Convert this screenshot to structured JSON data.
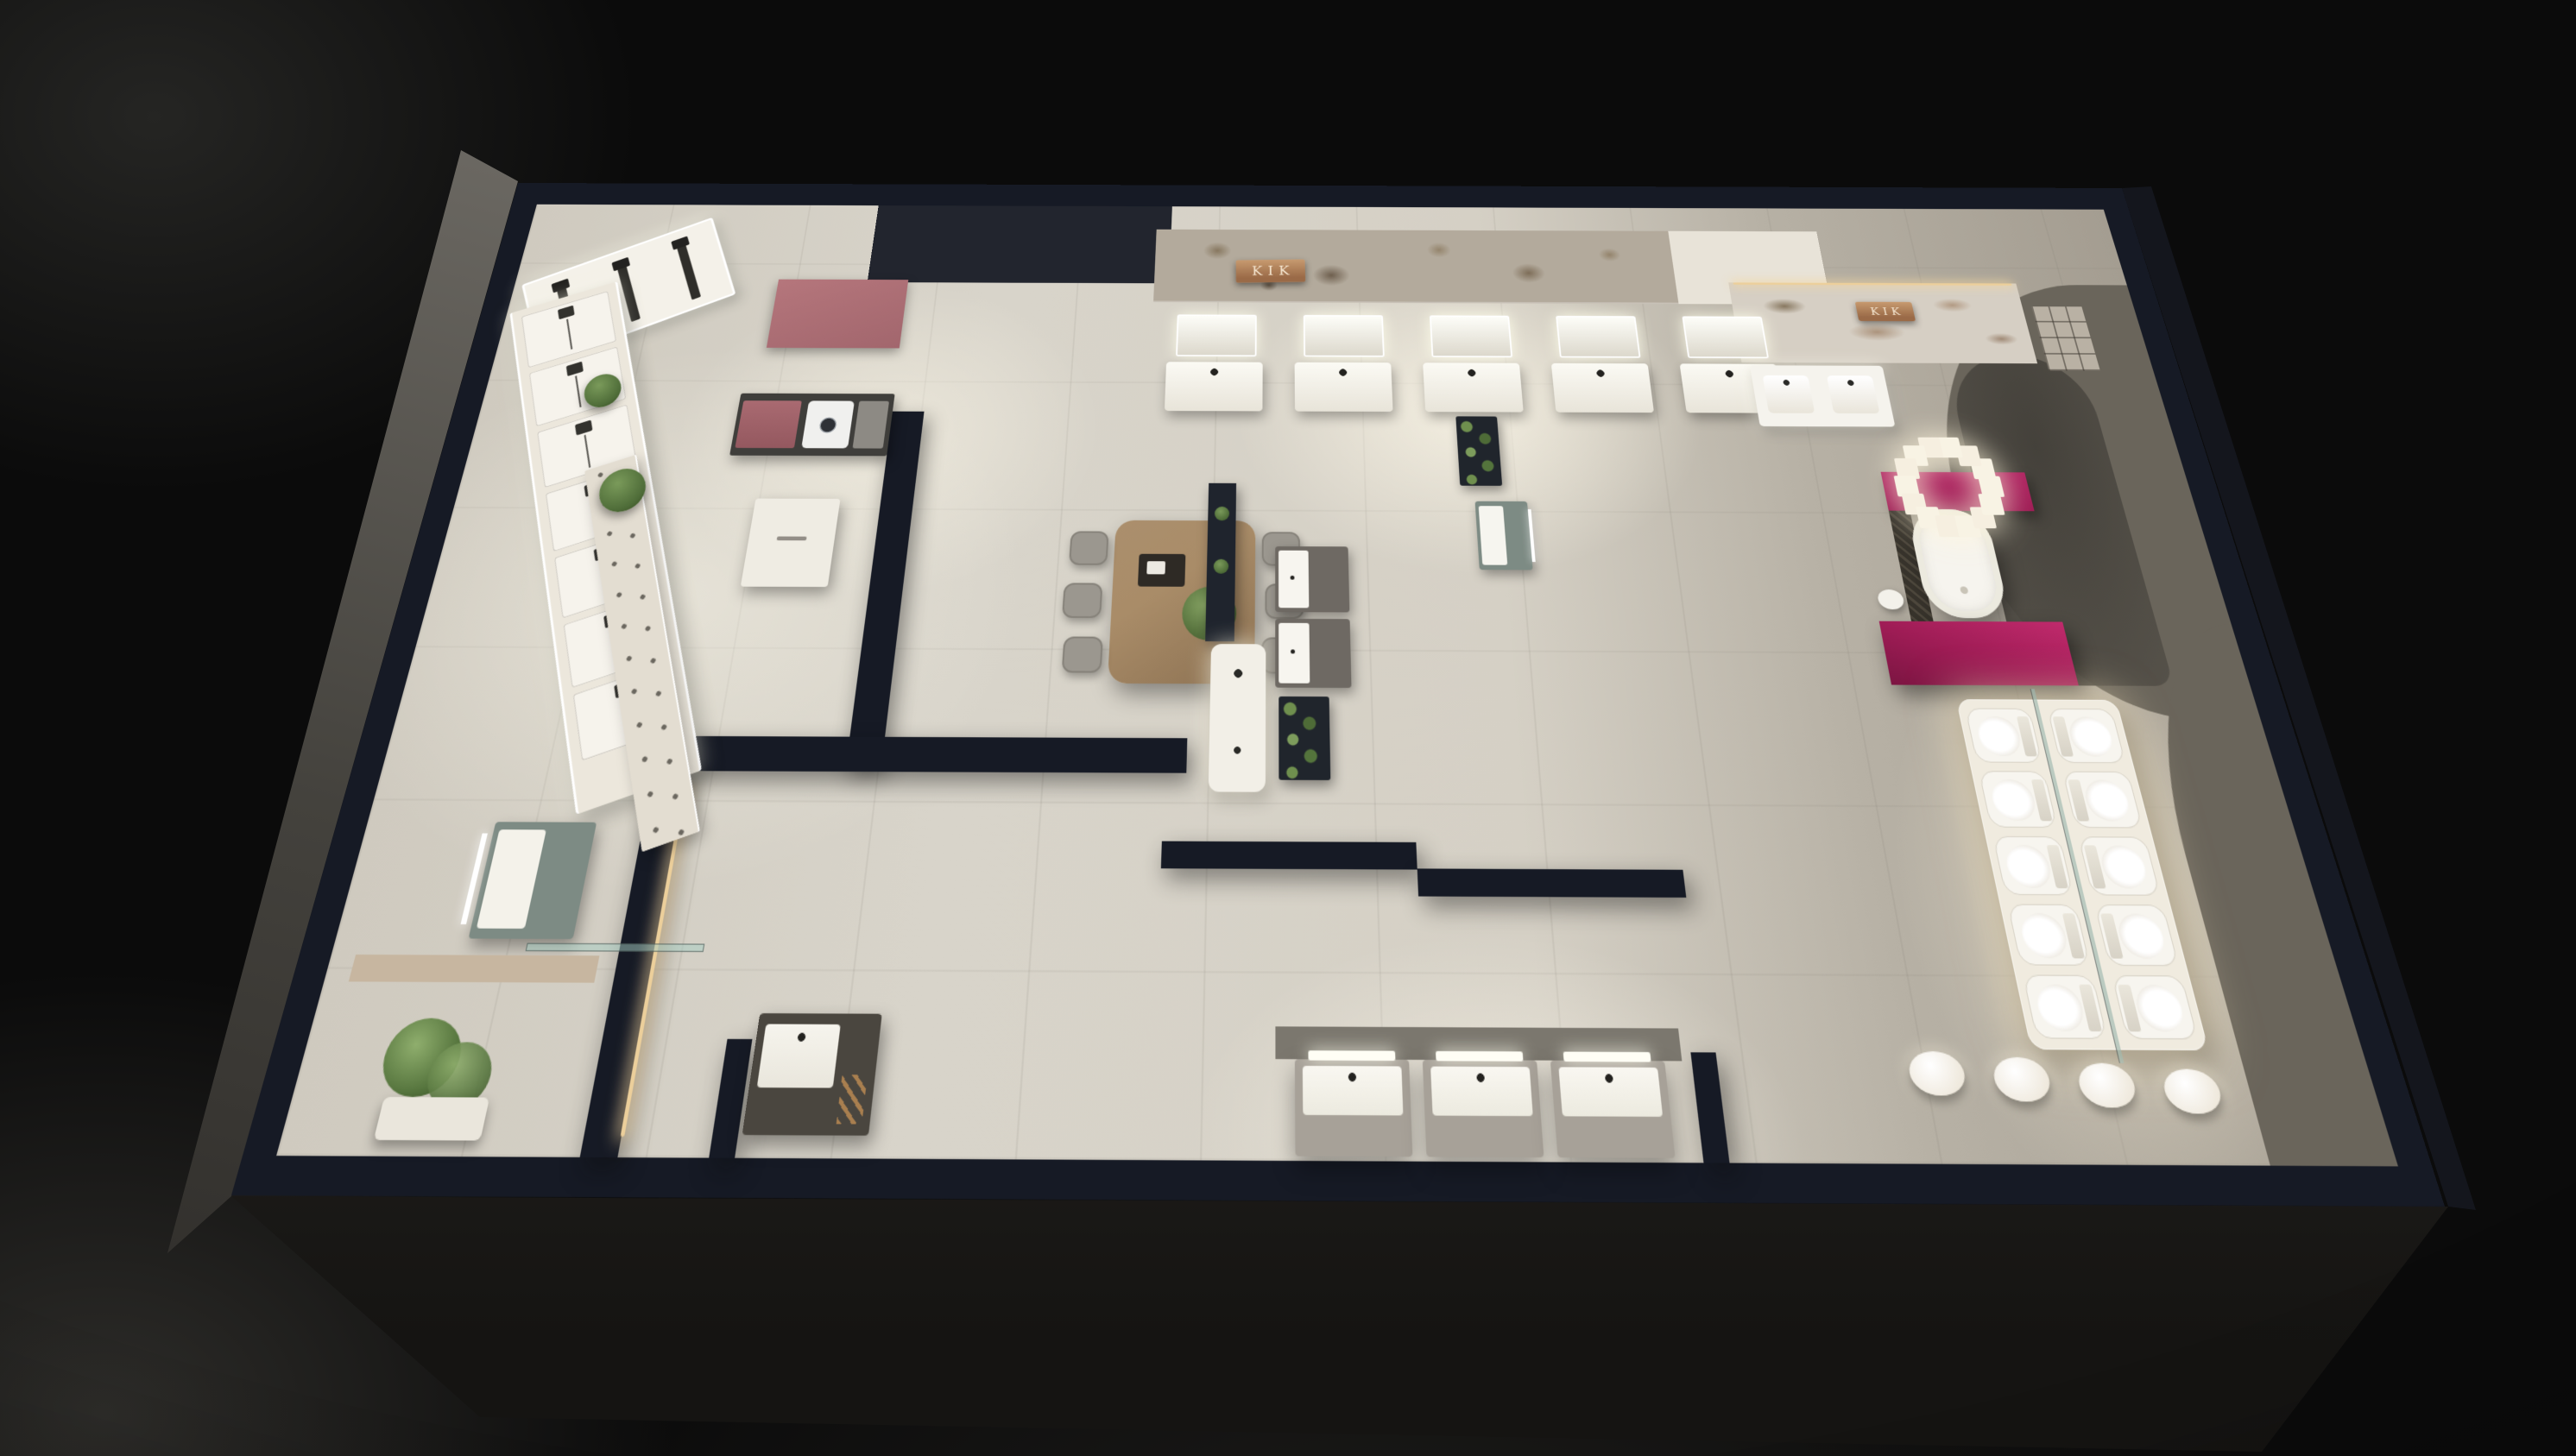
{
  "scene": {
    "title": "KIK bathroom showroom – 3D floor plan render",
    "view": "top-down dollhouse perspective at night, interior lit, black surround",
    "brand": "KIK"
  },
  "signs": [
    {
      "id": "stone-wall-sign",
      "text": "KIK"
    },
    {
      "id": "marble-wall-sign",
      "text": "KIK"
    }
  ],
  "inventory": {
    "shower_display_panels": 7,
    "shower_alcove_columns": 3,
    "faucet_display_shelves": 1,
    "top_vanity_units": 5,
    "mid_vanity_units": 2,
    "bottom_vanity_units": 3,
    "double_sink_vanities": 1,
    "toilets_on_platform": 10,
    "dining_chairs": 6,
    "egg_stools": 4,
    "freestanding_bathtubs": 1,
    "washing_machines": 1,
    "bubble_chandelier_globes": 14,
    "potted_plants": 5,
    "green_wall_planters": 3
  },
  "colors": {
    "navy": "#161a25",
    "floor": "#d8d4ca",
    "right_gray": "#a49d91",
    "shadow_gray": "#6a655b",
    "arch_gray": "#413e38",
    "magenta": "#9e1c55",
    "pink_panel": "#b5767c",
    "pink_cabinet": "#a96a71",
    "copper": "#9a6a47",
    "copper_light": "#c79a6f",
    "sign_text": "#f7e9d4",
    "wood": "#a98c68",
    "chair_gray": "#9b978f",
    "green_dark": "#4f6d39",
    "green_light": "#7a9a5a",
    "fixture_white": "#f7f5ef",
    "cabinet_gray": "#a7a198",
    "teal": "#7d8b84",
    "dark_cabinet": "#4a463f",
    "stone": "#b3aa9c",
    "stone_speck": "#87775f",
    "marble": "#d6cfc4",
    "led_warm": "#eccf9b",
    "glass": "#9fb9b0",
    "bg": "#0b0b0b"
  }
}
